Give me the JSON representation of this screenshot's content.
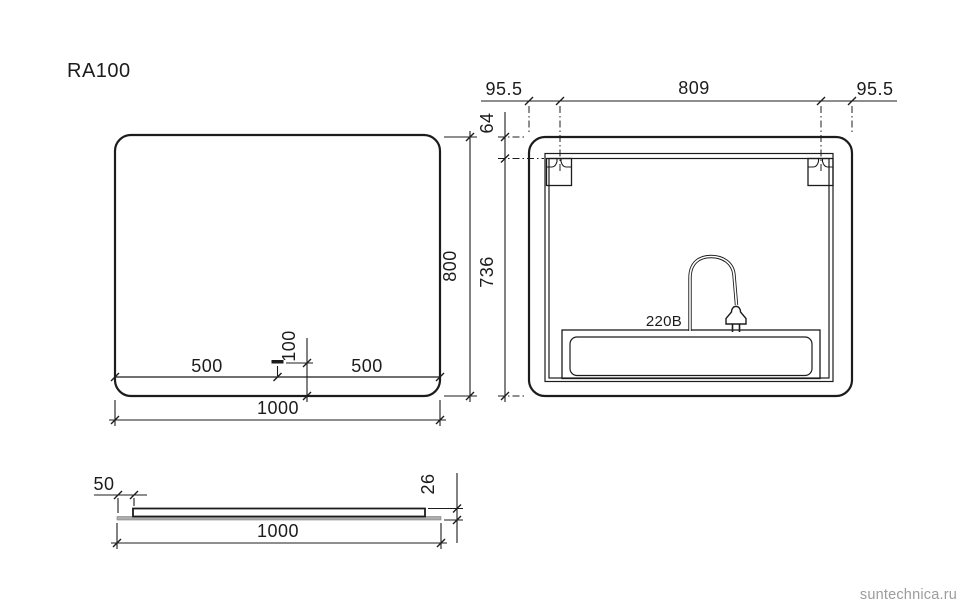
{
  "title": "RA100",
  "watermark": "suntechnica.ru",
  "front_view": {
    "width": "1000",
    "height": "800",
    "left_segment": "500",
    "right_segment": "500",
    "sensor_offset": "100"
  },
  "back_view": {
    "left_margin": "95.5",
    "bracket_span": "809",
    "right_margin": "95.5",
    "top_offset": "64",
    "bottom_span": "736",
    "voltage": "220В"
  },
  "side_view": {
    "edge_inset": "50",
    "thickness": "26",
    "width": "1000"
  }
}
